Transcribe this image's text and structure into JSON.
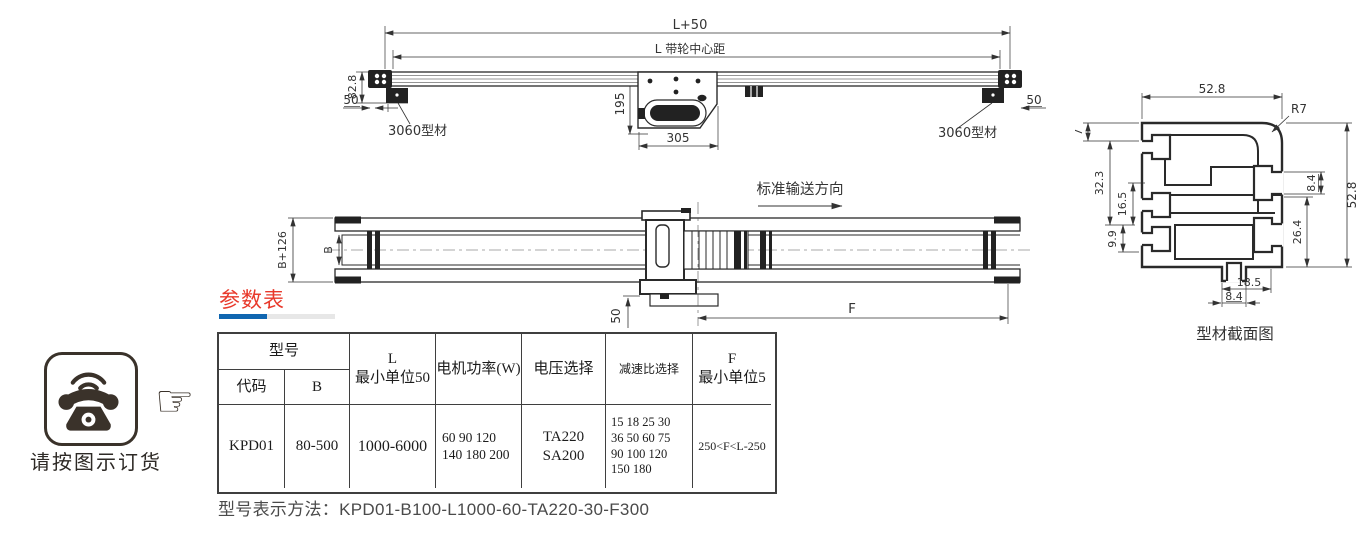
{
  "side_view": {
    "dim_total_length": "L+50",
    "dim_pulley_center": "L 带轮中心距",
    "dim_height": "82.8",
    "dim_offset_left": "50",
    "dim_motor_height": "195",
    "dim_motor_width": "305",
    "dim_offset_right": "50",
    "label_profile": "3060型材"
  },
  "plan_view": {
    "direction_label": "标准输送方向",
    "dim_width_outer": "B+126",
    "dim_width_belt": "B",
    "dim_motor_offset": "50",
    "dim_f": "F"
  },
  "profile_view": {
    "caption": "型材截面图",
    "dim_top_width": "52.8",
    "dim_radius": "R7",
    "dim_7": "7",
    "dim_32_3": "32.3",
    "dim_16_5": "16.5",
    "dim_9_9": "9.9",
    "dim_8_4_right": "8.4",
    "dim_height_right": "52.8",
    "dim_26_4": "26.4",
    "dim_18_5": "18.5",
    "dim_8_4_bottom": "8.4"
  },
  "params_section": {
    "title": "参数表",
    "table": {
      "header": {
        "model": "型号",
        "code": "代码",
        "b": "B",
        "l_line1": "L",
        "l_line2": "最小单位50",
        "motor_power": "电机功率(W)",
        "voltage": "电压选择",
        "ratio": "减速比选择",
        "f_line1": "F",
        "f_line2": "最小单位5"
      },
      "row": {
        "code": "KPD01",
        "b": "80-500",
        "l": "1000-6000",
        "power_line1": "60 90 120",
        "power_line2": "140 180 200",
        "voltage_line1": "TA220",
        "voltage_line2": "SA200",
        "ratio_line1": "15 18 25 30",
        "ratio_line2": "36 50 60 75",
        "ratio_line3": "90 100 120",
        "ratio_line4": "150 180",
        "f": "250<F<L-250"
      }
    },
    "model_note": "型号表示方法：KPD01-B100-L1000-60-TA220-30-F300"
  },
  "order_note": {
    "caption": "请按图示订货",
    "hand_icon": "☞"
  },
  "colors": {
    "accent_red": "#e8392b",
    "accent_blue": "#1066b0",
    "underline_gray": "#e7e7e7",
    "drawing_line": "#2a2a2a",
    "icon_ink": "#3a322a"
  }
}
